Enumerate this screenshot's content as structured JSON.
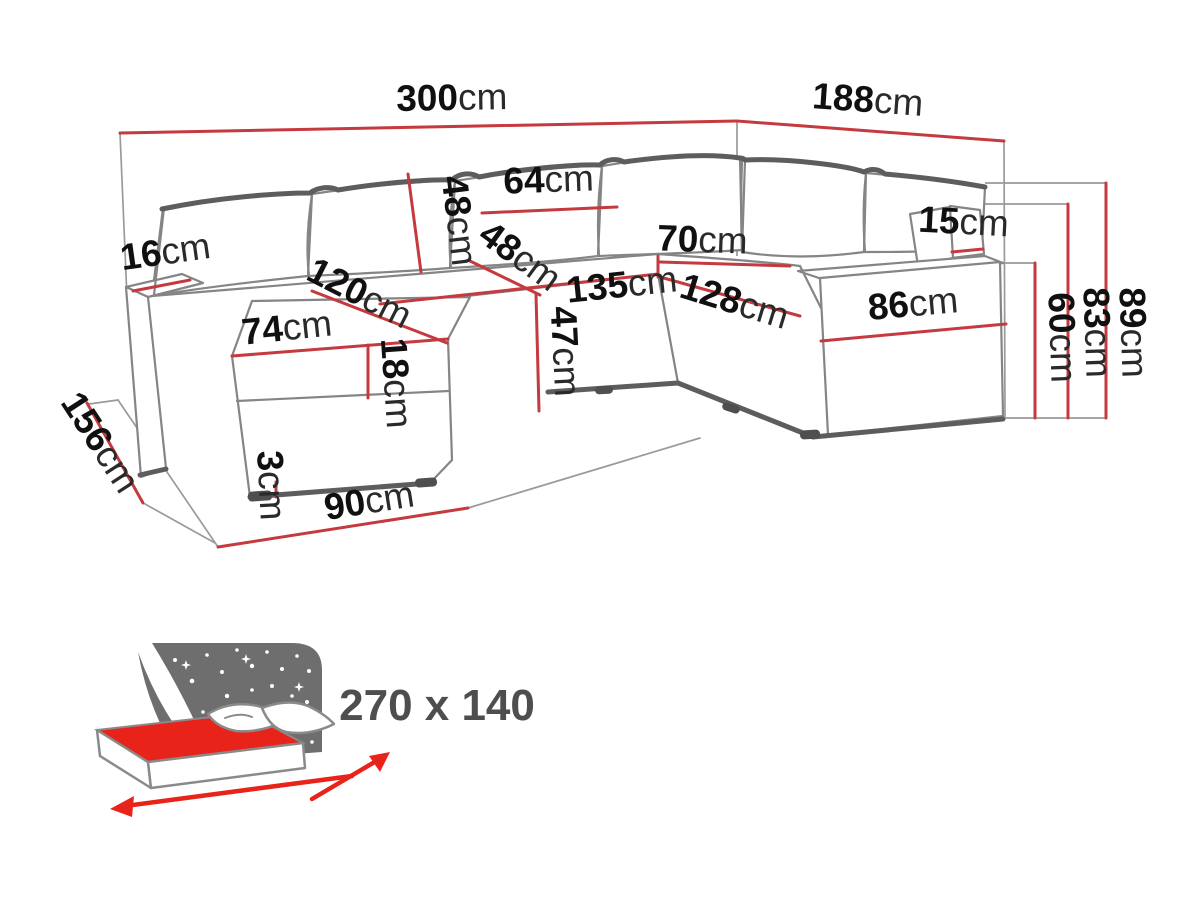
{
  "diagram_title": "corner-sofa-dimension-diagram",
  "colors": {
    "dimension_line_red": "#c43a3e",
    "sofa_outline_gray": "#858585",
    "label_black": "#141414",
    "icon_gray": "#6e6e6e",
    "mattress_red": "#e8231a",
    "area_label_gray": "#4e4e4e"
  },
  "dims": {
    "total_width": {
      "v": "300",
      "u": "cm"
    },
    "total_depth_right": {
      "v": "188",
      "u": "cm"
    },
    "armrest_width": {
      "v": "16",
      "u": "cm"
    },
    "back_pillow_height": {
      "v": "48",
      "u": "cm"
    },
    "back_pillow_width": {
      "v": "64",
      "u": "cm"
    },
    "seat_depth": {
      "v": "48",
      "u": "cm"
    },
    "corner_seat_width": {
      "v": "70",
      "u": "cm"
    },
    "arm_back_pillow_thickness": {
      "v": "15",
      "u": "cm"
    },
    "seat_width_left": {
      "v": "135",
      "u": "cm"
    },
    "seat_width_right": {
      "v": "128",
      "u": "cm"
    },
    "right_arm_length": {
      "v": "86",
      "u": "cm"
    },
    "seat_height": {
      "v": "47",
      "u": "cm"
    },
    "seat_cushion_thickness": {
      "v": "18",
      "u": "cm"
    },
    "chaise_length": {
      "v": "120",
      "u": "cm"
    },
    "chaise_width": {
      "v": "74",
      "u": "cm"
    },
    "chaise_floor_length": {
      "v": "90",
      "u": "cm"
    },
    "leg_height": {
      "v": "3",
      "u": "cm"
    },
    "total_depth_left": {
      "v": "156",
      "u": "cm"
    },
    "armrest_height": {
      "v": "60",
      "u": "cm"
    },
    "backrest_height": {
      "v": "83",
      "u": "cm"
    },
    "total_height": {
      "v": "89",
      "u": "cm"
    },
    "sleeping_area": {
      "v": "270 x 140",
      "u": ""
    }
  }
}
